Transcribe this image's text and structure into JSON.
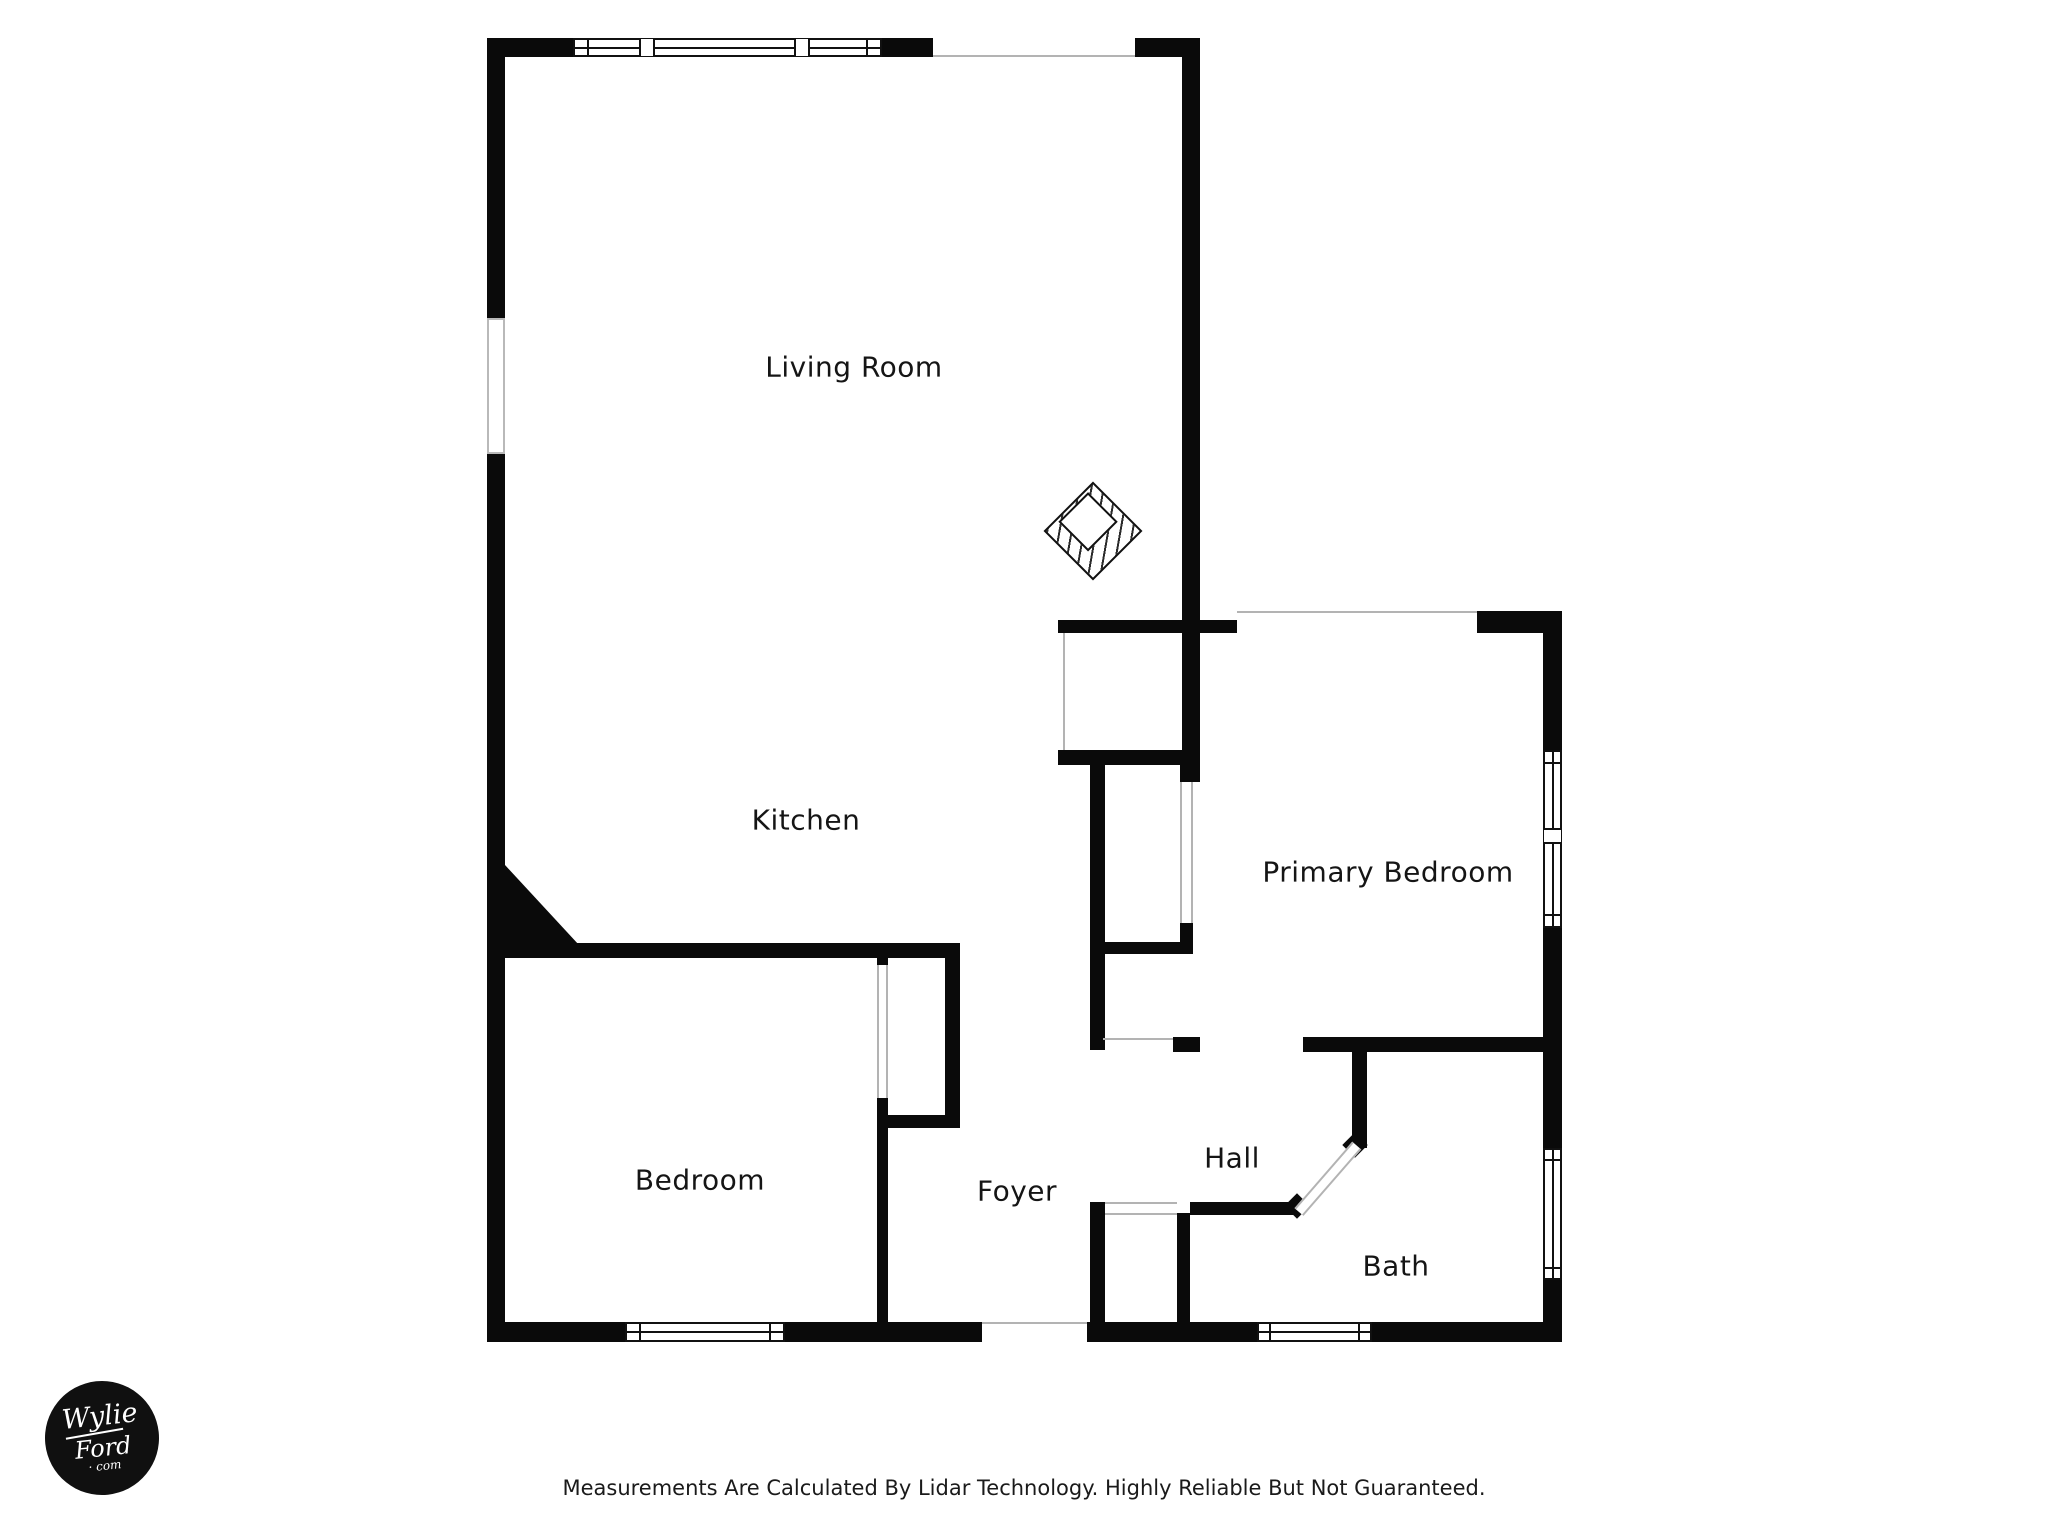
{
  "plan": {
    "title": "Apartment floor plan",
    "wall_color": "#0a0a0a",
    "opening_line_color": "#b3b3b3",
    "background": "#ffffff"
  },
  "rooms": [
    {
      "id": "living-room",
      "label": "Living Room"
    },
    {
      "id": "kitchen",
      "label": "Kitchen"
    },
    {
      "id": "primary-bedroom",
      "label": "Primary Bedroom"
    },
    {
      "id": "bedroom",
      "label": "Bedroom"
    },
    {
      "id": "foyer",
      "label": "Foyer"
    },
    {
      "id": "hall",
      "label": "Hall"
    },
    {
      "id": "bath",
      "label": "Bath"
    }
  ],
  "features": {
    "fireplace": "fireplace-symbol",
    "windows": [
      "living-room-top-window",
      "bedroom-bottom-window",
      "bath-bottom-window",
      "primary-bedroom-right-windows",
      "bath-right-window"
    ],
    "openings": [
      "balcony-opening-top",
      "living-room-left-opening",
      "entry-door-opening",
      "primary-closet-door",
      "bedroom-closet-door",
      "hall-closet-openings",
      "bath-diagonal-door"
    ]
  },
  "logo": {
    "line1": "Wylie",
    "line2": "Ford",
    "line3": "· com"
  },
  "footer": {
    "disclaimer": "Measurements Are Calculated By Lidar Technology. Highly Reliable But Not Guaranteed."
  }
}
